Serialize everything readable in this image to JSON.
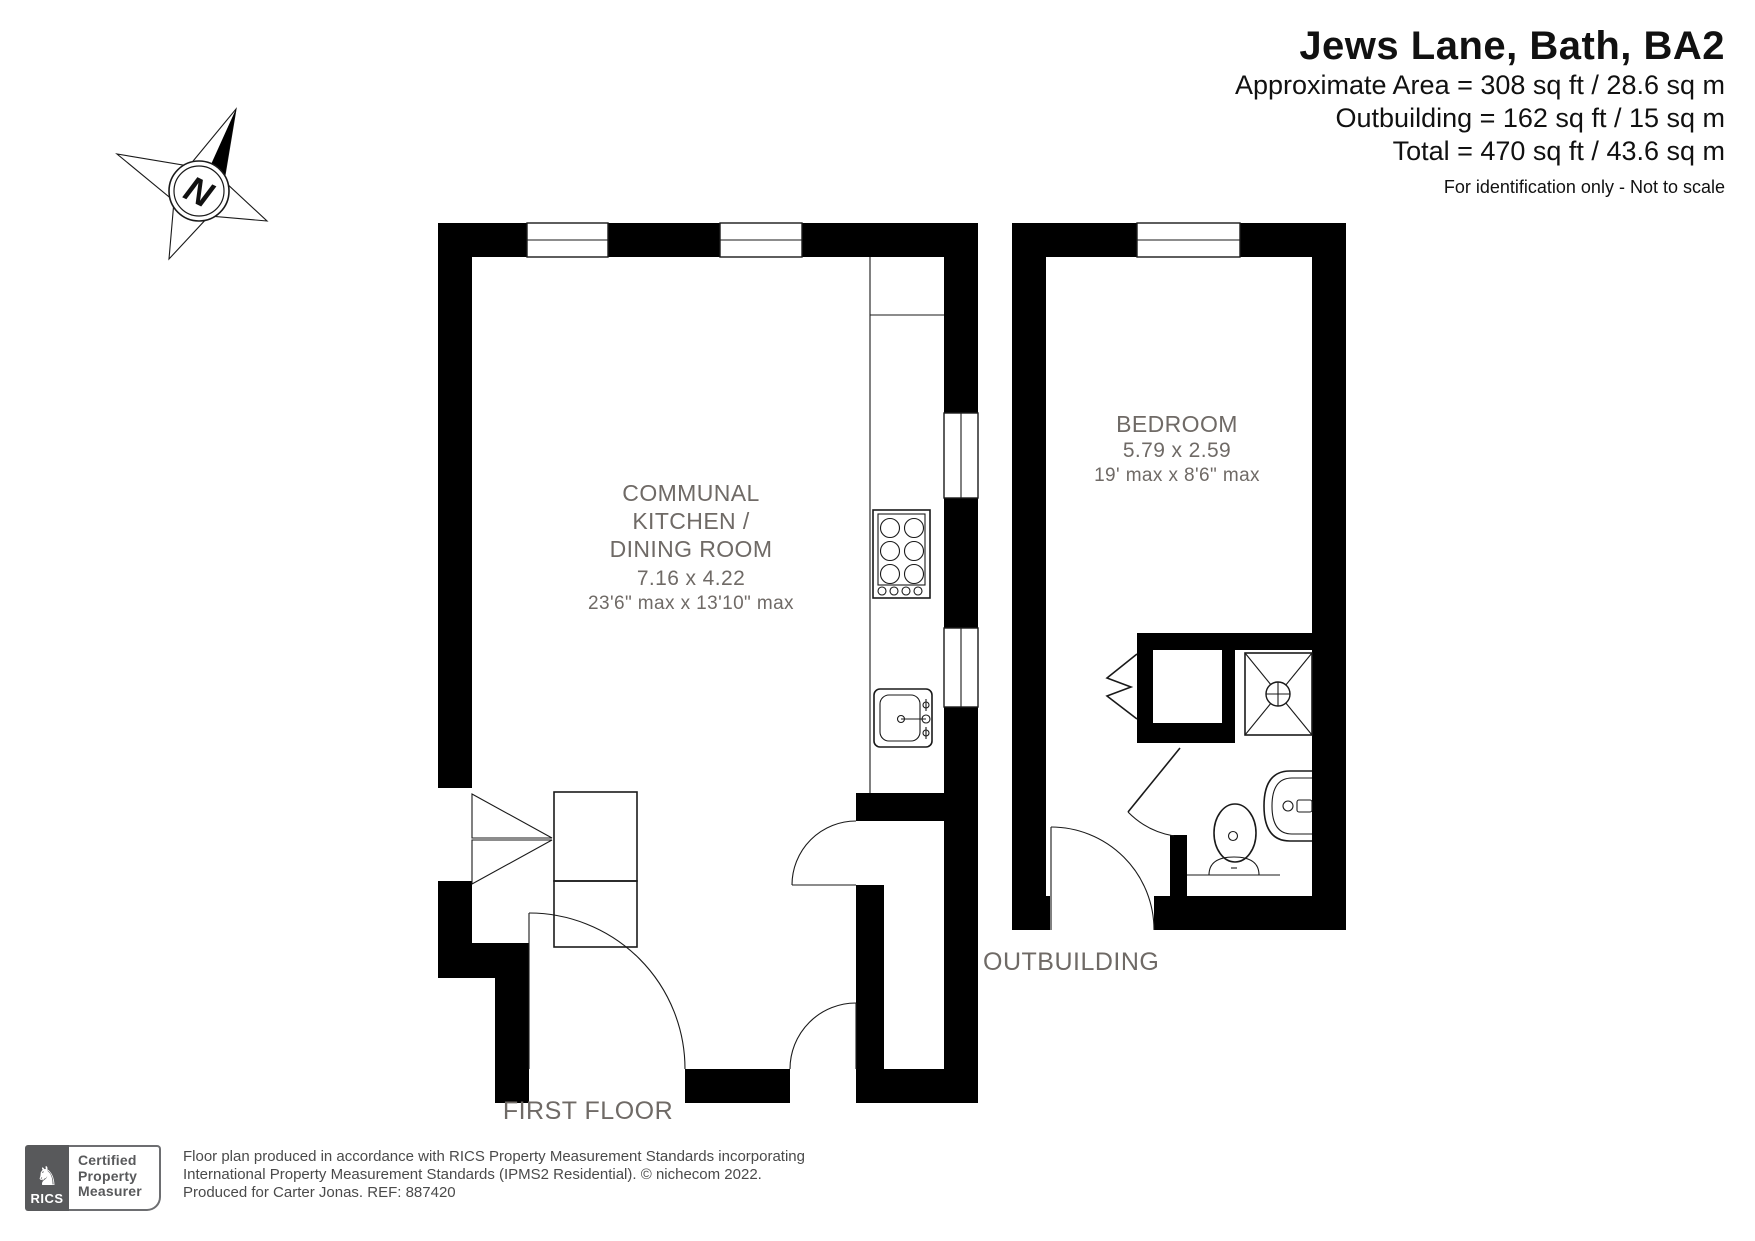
{
  "header": {
    "title": "Jews Lane, Bath, BA2",
    "area_line1": "Approximate Area = 308 sq ft / 28.6 sq m",
    "area_line2": "Outbuilding = 162 sq ft / 15 sq m",
    "area_line3": "Total = 470 sq ft / 43.6 sq m",
    "disclaimer": "For identification only - Not to scale"
  },
  "compass": {
    "north_label": "N"
  },
  "first_floor": {
    "label": "FIRST FLOOR",
    "room": {
      "name_line1": "COMMUNAL",
      "name_line2": "KITCHEN /",
      "name_line3": "DINING ROOM",
      "dims_metric": "7.16 x 4.22",
      "dims_imperial": "23'6\" max x 13'10\" max"
    }
  },
  "outbuilding": {
    "label": "OUTBUILDING",
    "room": {
      "name": "BEDROOM",
      "dims_metric": "5.79 x 2.59",
      "dims_imperial": "19' max x 8'6\" max"
    }
  },
  "footer": {
    "rics_label": "RICS",
    "badge_line1": "Certified",
    "badge_line2": "Property",
    "badge_line3": "Measurer",
    "attribution_line1": "Floor plan produced in accordance with RICS Property Measurement Standards incorporating",
    "attribution_line2": "International Property Measurement Standards (IPMS2 Residential).   © nichecom 2022.",
    "attribution_line3": "Produced for Carter Jonas.   REF:  887420"
  },
  "colors": {
    "wall": "#000000",
    "room_text": "#6f6a66",
    "badge_gray": "#58595b"
  }
}
